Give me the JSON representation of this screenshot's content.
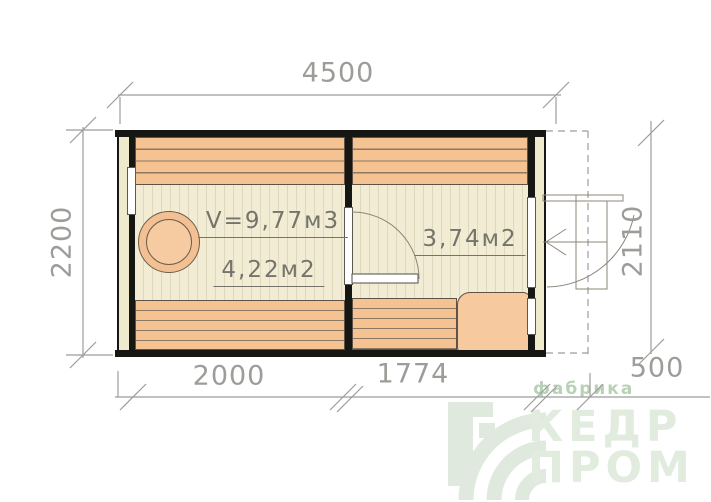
{
  "drawing": {
    "dims": {
      "width_total": "4500",
      "height_left": "2200",
      "height_right": "2110",
      "room_left_width": "2000",
      "room_right_width": "1774",
      "porch_depth": "500"
    },
    "rooms": {
      "steam_room": {
        "volume_label": "V=9,77м3",
        "area_label": "4,22м2"
      },
      "dressing_room": {
        "area_label": "3,74м2"
      }
    }
  },
  "watermark": {
    "tagline": "фабрика",
    "brand_line1": "КЕДР",
    "brand_line2": "ПРОМ"
  },
  "colors": {
    "wall_black": "#161613",
    "plank_orange": "#f5c291",
    "floor_cream": "#f1ecd3",
    "dim_gray": "#9c9c99",
    "logo_green": "#dfe9dd"
  }
}
